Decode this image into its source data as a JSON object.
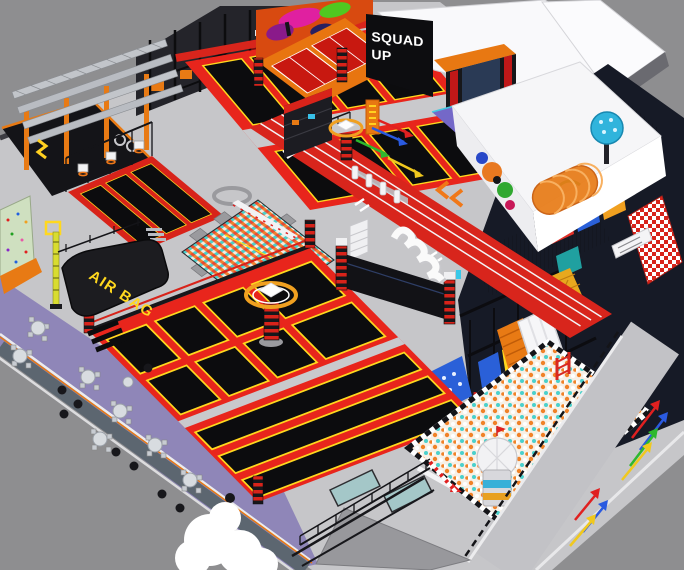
{
  "scene": {
    "description": "3D isometric render of an indoor trampoline park with soft-play playground, ball pit, foam pit, running track and cafe seating",
    "background_color": "#8e8e90",
    "floor_color": "#c6c6c9"
  },
  "signs": {
    "squad_up_line1": "SQUAD",
    "squad_up_line2": "UP",
    "air_bag": "AIR BAG"
  },
  "palette": {
    "trampoline_red": "#d8231a",
    "trampoline_black": "#0c0c0e",
    "trampoline_yellow": "#ffd81e",
    "orange": "#e87a14",
    "cafe_purple": "#8f86b8",
    "foam_teal": "#4ad0cc",
    "track_red": "#d8251c",
    "outer_wall_gray": "#5c6670",
    "ballpit_orange": "#f08228",
    "playground_frame": "#161a26",
    "panel_blue": "#2a60d8",
    "dome_blue": "#30b4dc",
    "roof_white": "#f9f9fb"
  }
}
